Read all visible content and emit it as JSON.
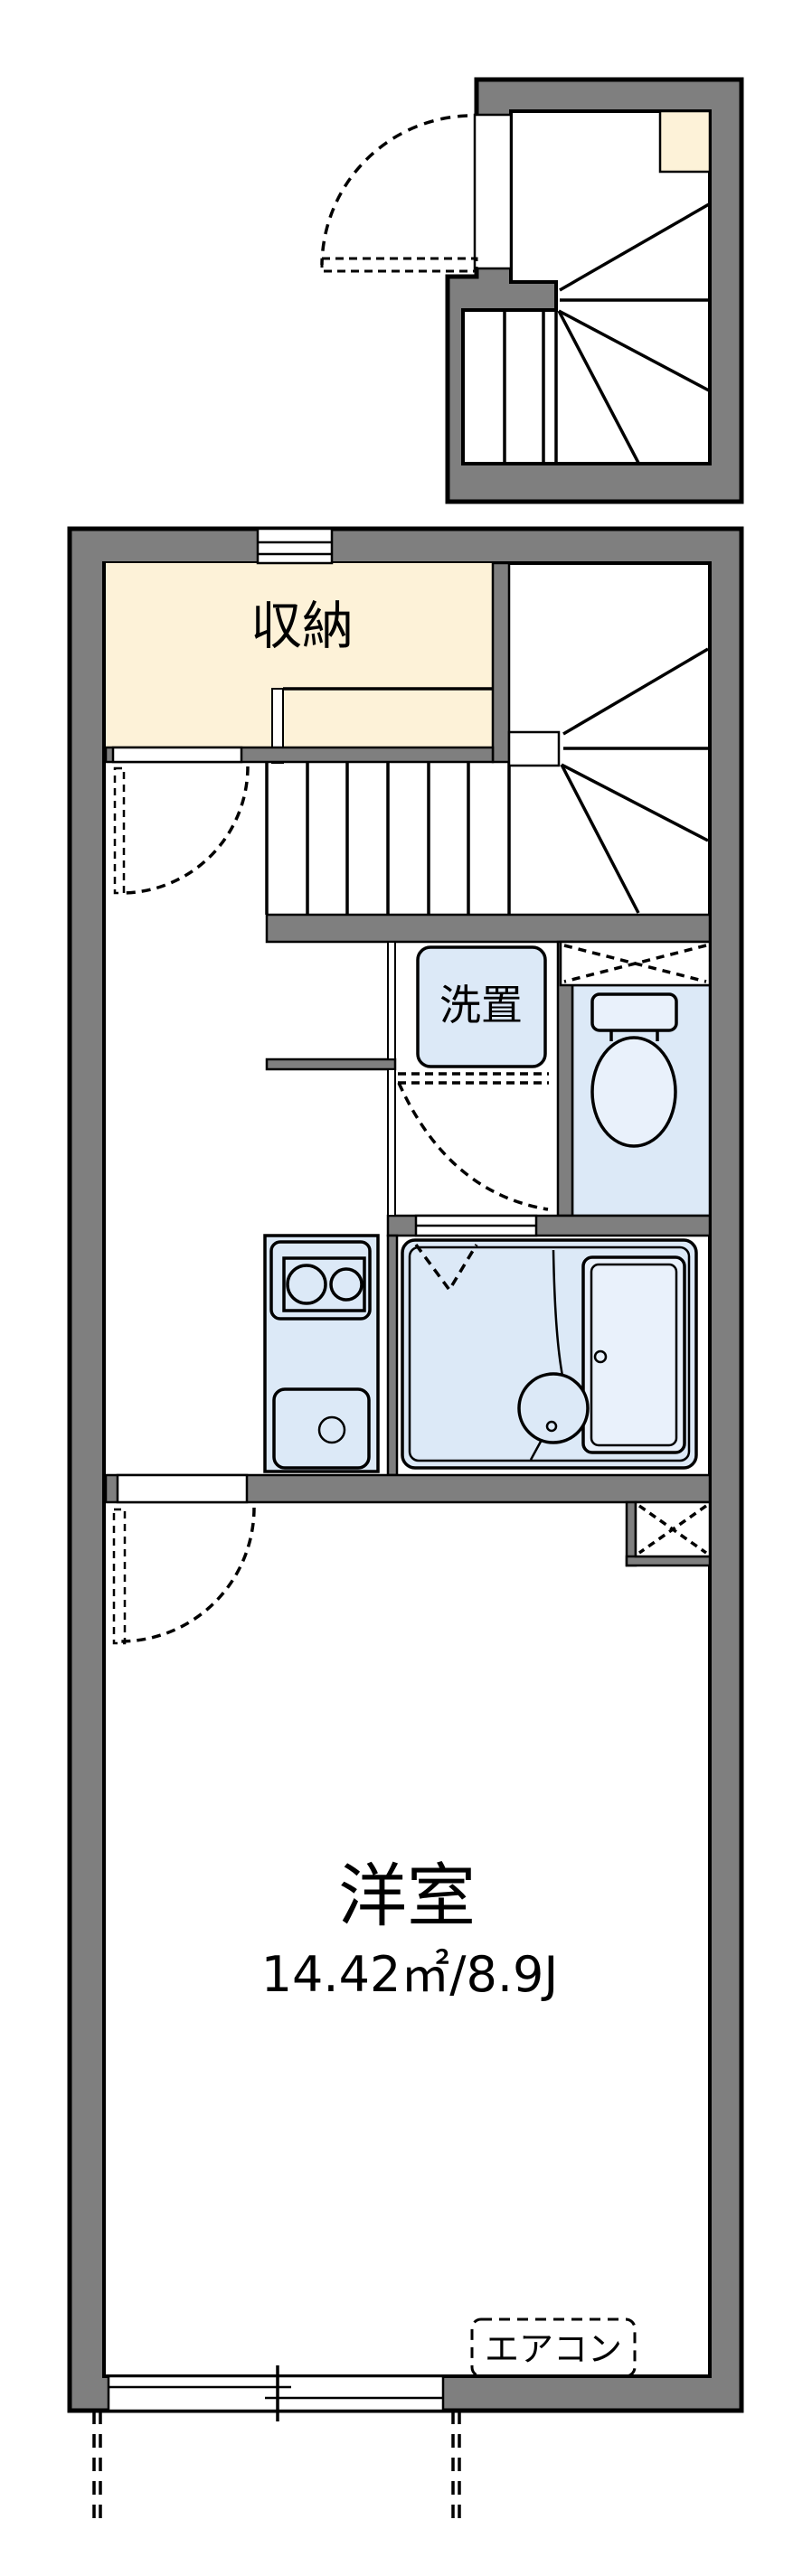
{
  "floorplan": {
    "colors": {
      "wall": "#7f7f7f",
      "closet": "#fdf2d8",
      "fixture": "#dce9f7",
      "fixture_light": "#e9f1fb",
      "line": "#000000",
      "bg": "#ffffff"
    },
    "labels": {
      "closet": "収納",
      "washer": "洗置",
      "room_name": "洋室",
      "room_area": "14.42㎡/8.9J",
      "aircon": "エアコン"
    }
  }
}
